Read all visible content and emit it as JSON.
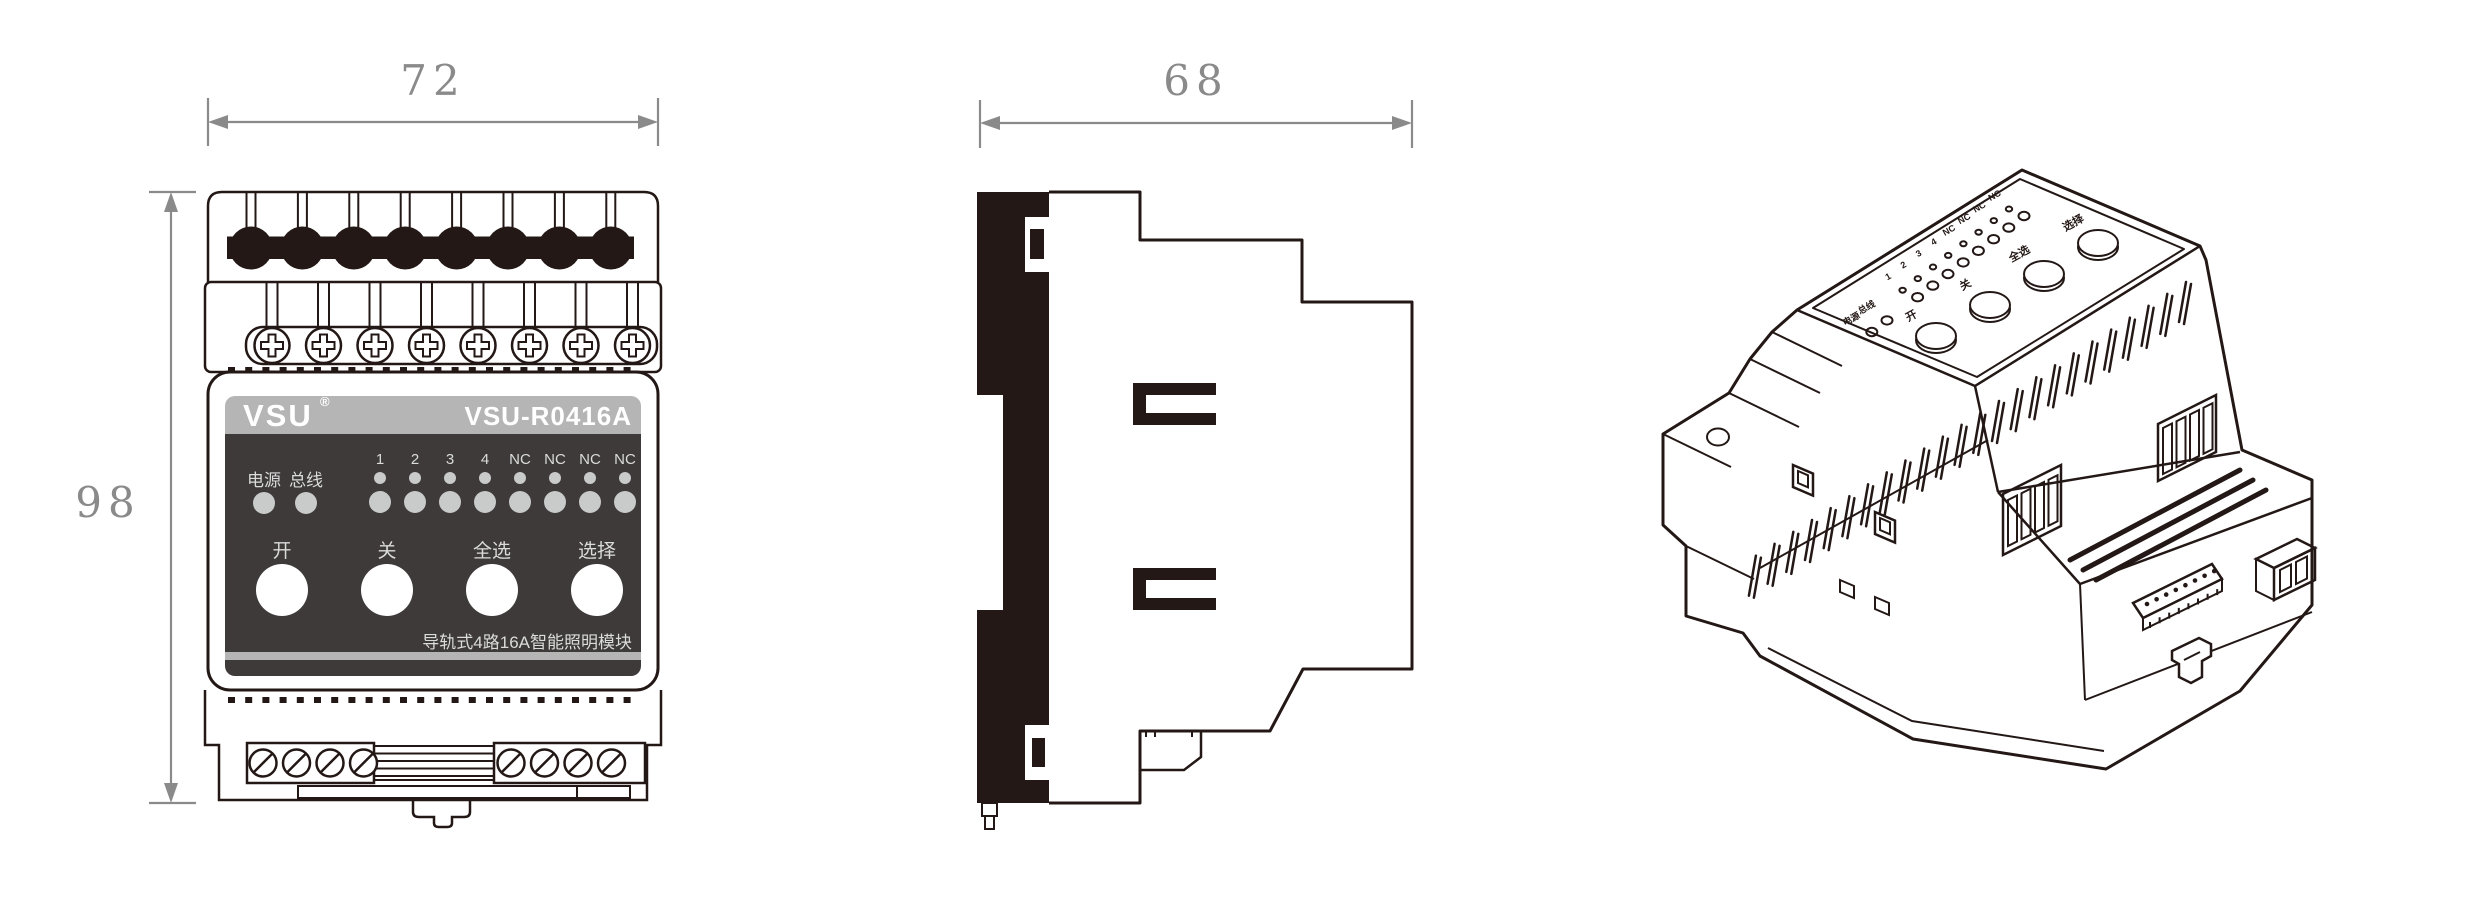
{
  "front": {
    "dim_width": "72",
    "dim_height": "98",
    "brand": "VSU",
    "brand_reg": "®",
    "model": "VSU-R0416A",
    "led_power": "电源",
    "led_bus": "总线",
    "channels": [
      "1",
      "2",
      "3",
      "4",
      "NC",
      "NC",
      "NC",
      "NC"
    ],
    "buttons": [
      "开",
      "关",
      "全选",
      "选择"
    ],
    "caption": "导轨式4路16A智能照明模块"
  },
  "side": {
    "dim_width": "68"
  },
  "colors": {
    "line": "#231815",
    "dim": "#8a8a8a",
    "panel": "#3f3a3a",
    "band": "#b5b5b6",
    "led": "#c9caca",
    "panel_text": "#dadbdb"
  }
}
